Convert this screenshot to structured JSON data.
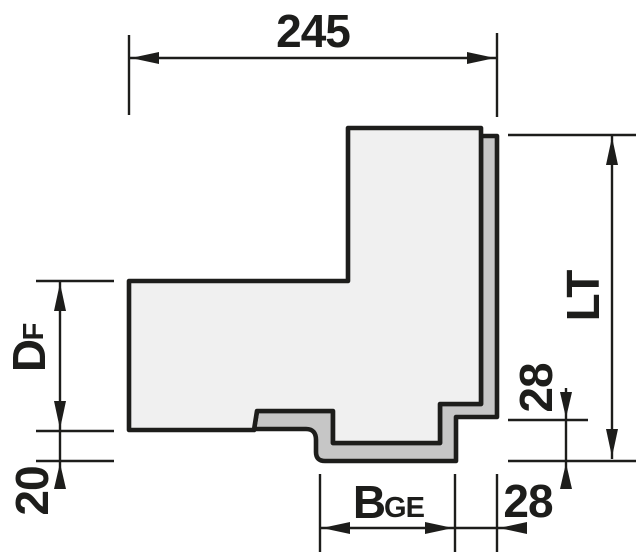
{
  "page": {
    "background": "#ffffff"
  },
  "drawing": {
    "description": "Dimensioned cross-section of a corner frame profile with seal strip",
    "colors": {
      "outline": "#1d1d1b",
      "profile_fill": "#f0f0f0",
      "seal_fill": "#c6c6c6"
    },
    "dims": {
      "top_width": "245",
      "frame_depth": "D",
      "frame_depth_sub": "F",
      "bottom_offset": "20",
      "groove_width": "B",
      "groove_width_sub": "GE",
      "step_width": "28",
      "right_offset": "28",
      "total_length": "LT"
    }
  }
}
